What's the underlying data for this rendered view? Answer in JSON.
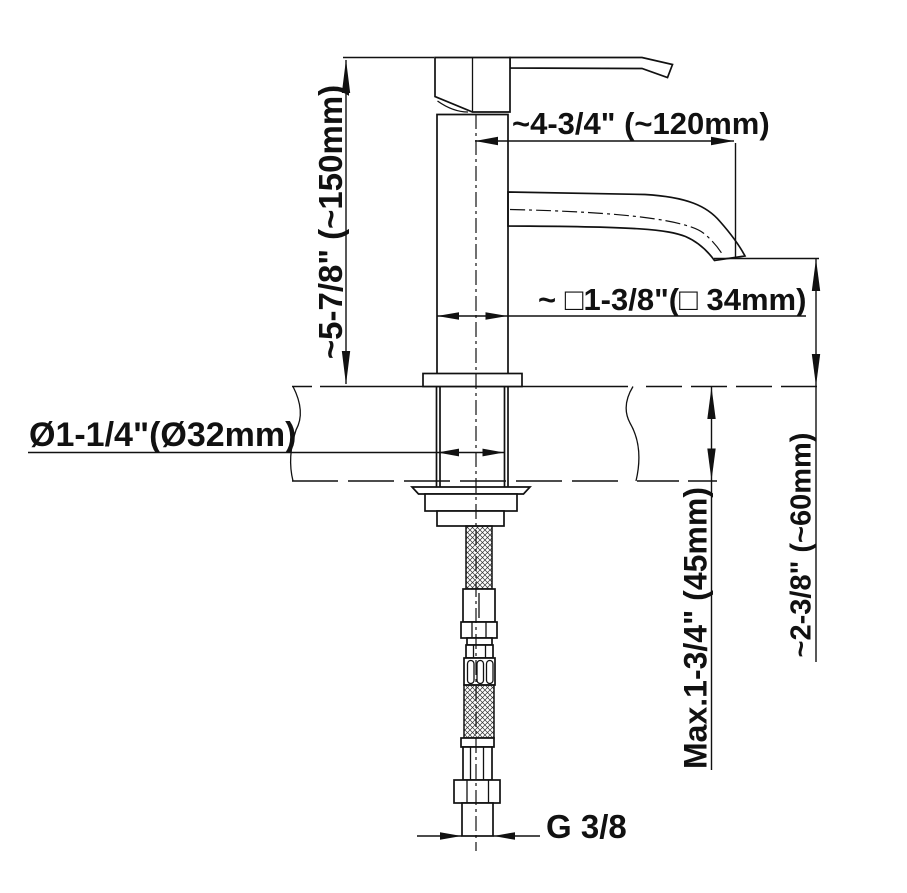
{
  "drawing": {
    "labels": {
      "spout_reach": "~4-3/4\" (~120mm)",
      "total_height": "~5-7/8\" (~150mm)",
      "body_width": "~ □1-3/8\"(□ 34mm)",
      "hole_diameter": "Ø1-1/4\"(Ø32mm)",
      "max_deck_thickness": "Max.1-3/4\" (45mm)",
      "spout_height": "~2-3/8\" (~60mm)",
      "thread_size": "G 3/8"
    },
    "colors": {
      "line": "#111111",
      "background": "#ffffff"
    }
  }
}
